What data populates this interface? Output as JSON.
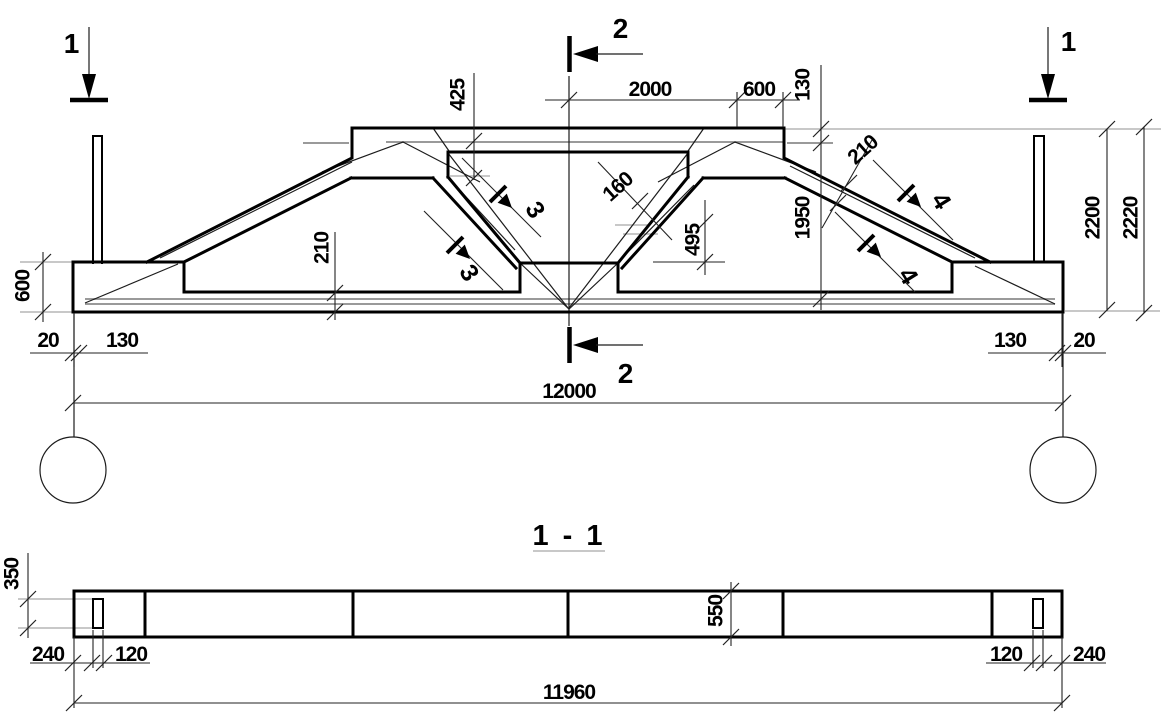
{
  "drawing": {
    "kind": "reinforced-concrete truss shop drawing, elevation and horizontal section",
    "section_view_title": "1 - 1"
  },
  "elevation": {
    "section_markers": {
      "s1": "1",
      "s2": "2"
    },
    "detail_markers": {
      "s3": "3",
      "s4": "4"
    },
    "dims": {
      "top_half_span": "2000",
      "top_end_panel": "600",
      "top_step": "130",
      "rebar_offset": "425",
      "strut_width": "160",
      "chord_thickness": "210",
      "slope_height": "1950",
      "opening_height": "495",
      "end_block_height": "600",
      "bottom_chord_thickness": "210",
      "edge_gap_left": "20",
      "loop_offset_left": "130",
      "loop_offset_right": "130",
      "edge_gap_right": "20",
      "overall_length": "12000",
      "height_inner": "2200",
      "height_overall": "2220"
    }
  },
  "section_view": {
    "title": "1 - 1",
    "dims": {
      "loop_depth": "350",
      "width": "550",
      "end_to_loop_left": "240",
      "loop_width_left": "120",
      "loop_width_right": "120",
      "end_to_loop_right": "240",
      "length": "11960"
    }
  }
}
